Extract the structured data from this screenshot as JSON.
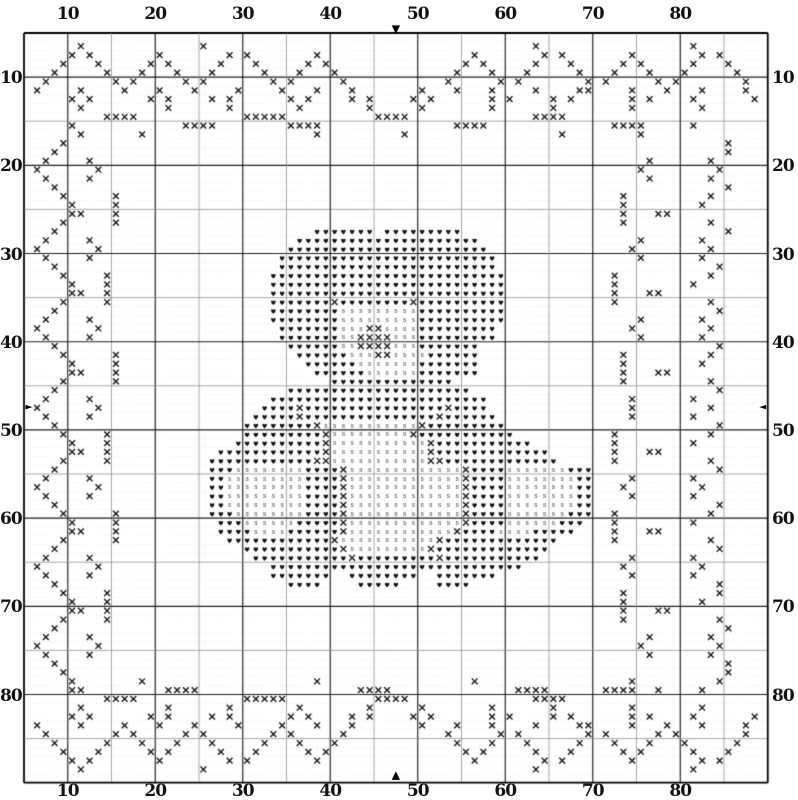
{
  "pattern": {
    "columns": 85,
    "rows": 85,
    "symbols": {
      "x": "cross-stitch-x",
      "h": "heart-stitch",
      "s": "light-accent-stitch",
      ".": "empty"
    },
    "motif": "teddy-bear-with-x-vine-border",
    "cell_rows": [
      ".....................................................................................",
      "......x.............x.....................................x.................x.......",
      ".....x.x.......x.......x.x.......x.................x.......x.x.......x.......x.x.....",
      "....x...x.....x.x.....x...x.....x.x...............x.x.....x...x.....x.x.....x...x....",
      "...x.....x...x...x...x.....x...x...x.............x...x...x.....x...x...x...x.....x...",
      "..x.......x.x.....x.x.......x.x.....x...........x.....x.x.......x.x.....x.x.......x..",
      ".x....x....x...x...x....x....x...x...x.......x...x...x....x....xx....x...x...x....x..",
      ".....x.x......x.x....x.x......x.x....x.x....x.x......x.x....x.x......x.x....x......x.",
      "......x.........x......x.......x.......x.....x.......x......x........x.......x.......",
      ".........xxxx............xxxxx..........xxxx..............xxxx......................",
      ".....x............xxxx........xxxx...............xxxx..............xxxx.....x.......",
      "......x......x...................x.........x.................x........x.............",
      "....x...........................................................................x...",
      "...x............................................................................x...",
      "..x....x...............................................................x......x.....",
      ".x......x.............................................................x........x....",
      "..x....x...............................................................x......x.....",
      "...x............................................................................x...",
      "....x.....x.........................................................x.........x.....",
      ".....x....x.........................................................x........x......",
      ".....xx...x.........................................................x...xx..........",
      "....x.....x.........................................................x.........x.....",
      "...x.............................hhhhhhh.hhhhhhhhh..............................x...",
      "..x....x.......................hhhhhhhhhhhhhhhhhhhhh..................x......x......",
      ".x......x.....................hhhhhhhhhhhhhhhhhhhhhhh................x........x.....",
      "..x....x.....................hhhhhhhhhhhhhhhhhhhhhhhhh................x......x......",
      "...x.........................hhhhhhhhhhhhhhhhhhhhhhhhh.........................x....",
      "....x....x..................hhhhhhhhhhhhhhhhhhhhhhhhhhh............x..........x.....",
      ".....x...x..................hhhhhhhhhhhhhhhhhhhhhhhhhhh............x........x.......",
      ".....xx..x..................hhhhhhhhhhhhhhhhhhhhhhhhhhh............x...xx...........",
      "....x....x..................hhhhhhhxhhhhhhhhxhhhhhhhhhh............x..........x.....",
      "...x........................hhhhhhhhssssssssshhhhhhhhhh........................x....",
      "..x....x....................hhhhhhhhssssssssshhhhhhhhhh...............x......x......",
      ".x......x....................hhhhhhhsssxxsssshhhhhhhhh...............x........x.....",
      "..x....x.....................hhhhhhhssxxxxssshhhhhhhhh................x......x......",
      "...x..........................hhhhhhssxxxxssshhhhhhh...........................x....",
      "....x.....x....................hhhhhhsssxxsssshhhhhh................x.........x.....",
      ".....x....x.....................hhhhhhssssssshhhhhhh................x........x......",
      ".....xx...x......................hhhhhhsssssshhhhhhh................x...xx..........",
      "....x.....x........................hhhhhhhhhhhhhh...................x.........x.....",
      "...x..........................hhhhhhhhhhhhhhhhhhhhh............................x....",
      "..x....x....................hhhhhhhhhhhhhhhhhhhhhhhhh................x......x......",
      ".x......x..................hhhhxhhhhhhhhhhhhhhhhxhhhh................x........x.....",
      "..x....x..................hhhhhxhhhhhhhhhhhhhhhxhhhhhh...............x......x......",
      "...x.....................hhhhhhhhxsssssssssssxhhhhhhhhh........................x....",
      "....x....x...............hhhhhhhhhxsssssssssxhhhhhhhhhhh...........x..........x.....",
      ".....x...x..............hhhhhhhhhhxsssssssssssxhhhhhhhhhhh.........x........x.......",
      ".....xx..x............hhhhhhhhhhhhxsssssssssssxhhhhhhhhhhhhh.......x...xx...........",
      "....x....x...........hhhhhhhhhhhhxxsssssssssssxxhhhhhhhhhhhhh......x..........x.....",
      "...x.................hhhsssssssshhhhxsssssssssssssxhhhhssssssshhh..............x....",
      "..x....x.............hhssssssssshhhhxsssssssssssssxhhhhsssssssshh....x......x.......",
      ".x......x............hhssssssssshhhhxsssssssssssssxhhhhsssssssshh...x........x......",
      "..x....x.............hhssssssssshhhhxsssssssssssssxhhhhsssssssshh....x......x.......",
      "...x.................hhssssssssshhhhxsssssssssssssxhhhhsssssssshh..............x....",
      "....x.....x..........hhhsssssssshhhhxsssssssssssssxhhhhssssssshhh..x..........x.....",
      ".....x....x...........hhhsssssshhhhhxsssssssssssssxhhhhsssssshhh...x........x.......",
      ".....xx...x...........hhhhsssshhhhhhxssssssssssssxhhhhsssshhhhh....x...xx...........",
      "....x.....x............hhhhhhhhhhhhxsssssssssssxhhhhhhhhhhhhh......x..........x.....",
      "...x.....................hhhhhhhhhhhxsssssssssxhhhhhhhhhhhhh...................x....",
      "..x....x..................hhhhhhhhhhhxhhhhhhhhhxhhhhhhhhhhh..........x......x......",
      ".x......x...................hhhhhhhhhhhhhhhhhhhhhhhhhhhhh...........x........x.....",
      "..x....x....................hhhhhhh..hhhhhhhh..hhhhhhh...............x......x......",
      "...x..........................hhhh....hhhhh....hhhh............................x....",
      "....x....x..........................................................x..........x.....",
      ".....x...x..........................................................x........x......",
      ".....xx..x..........................................................x...xx..........",
      "....x....x..........................................................x..........x....",
      "...x............................................................................x...",
      "..x....x...............................................................x......x.....",
      ".x......x.............................................................x........x....",
      "..x....x...............................................................x......x.....",
      "...x............................................................................x...",
      "....x...........................................................................x...",
      ".....x.......x...................x.................x.................x.........x.....",
      ".....xx.........xxxx..................xxxx..............xxxx......xxxx..x....x......",
      ".........xxxx............xxxxx..........xxxx..............xxxx......................",
      "......x.........x......x.......x.......x.....x.......x......x........x.......x.......",
      ".....x.x......x.x....x.x......x.x....x.x....x.x......x.x....x.x......x.x....x......x.",
      ".x....x....x...x...x....x....x...x...x.......x...x...x....x....xx....x...x...x....x..",
      "..x.......x.x.....x.x.......x.x.....x...........x.....x.x.......x.x.....x.x.......x..",
      "...x.....x...x...x...x.....x...x...x.............x...x...x.....x...x...x...x.....x...",
      "....x...x.....x.x.....x...x.....x.x...............x.x.....x...x.....x.x.....x...x....",
      ".....x.x.......x.......x.x.......x.................x.......x.x.......x.......x.x.....",
      "......x.............x.....................................x.................x.......",
      "....................................................................................."
    ]
  },
  "axes": {
    "top": [
      10,
      20,
      30,
      40,
      50,
      60,
      70,
      80
    ],
    "bottom": [
      10,
      20,
      30,
      40,
      50,
      60,
      70,
      80
    ],
    "left": [
      10,
      20,
      30,
      40,
      50,
      60,
      70,
      80
    ],
    "right": [
      10,
      20,
      30,
      40,
      50,
      60,
      70,
      80
    ],
    "label_offset_cells": 5,
    "gridline_step": 5
  },
  "center_markers": {
    "top": "▼",
    "bottom": "▲",
    "left": "►",
    "right": "◄"
  },
  "colors": {
    "ink": "#111111",
    "grid_major": "#1f1f1f",
    "grid_minor": "#8a8a8a",
    "background": "#ffffff"
  }
}
